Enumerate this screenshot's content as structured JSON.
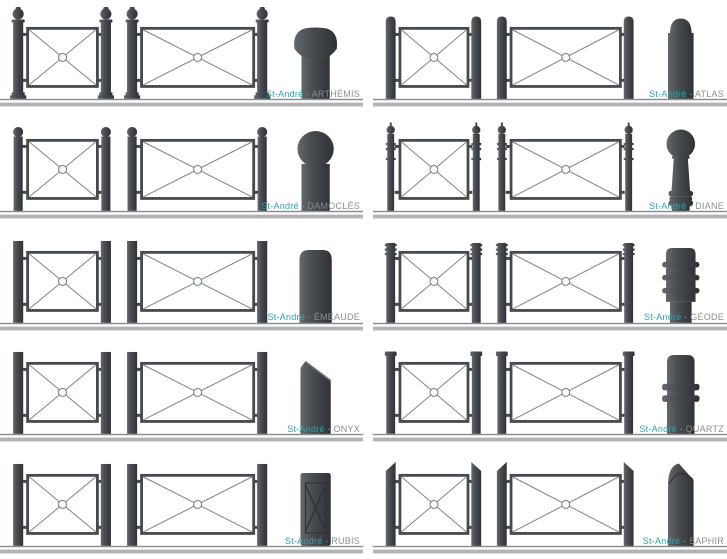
{
  "page": {
    "brand": "St-André",
    "separator": " - "
  },
  "colors": {
    "background": "#ffffff",
    "brand_text": "#2fa3aa",
    "product_text": "#8b9094",
    "metal_light": "#63686c",
    "metal_mid": "#484c50",
    "metal_dark": "#2f3337",
    "panel_frame": "#46494d",
    "panel_fill": "#ffffff",
    "panel_line": "#7f8487",
    "ground_line": "#888b8d",
    "separator_band": "#b1b3b5"
  },
  "products": [
    {
      "name": "ARTHÉMIS",
      "post_style": "ball-finial",
      "bollard_style": "mushroom-cap"
    },
    {
      "name": "ATLAS",
      "post_style": "round-top",
      "bollard_style": "dome-cylinder"
    },
    {
      "name": "DAMOCLÉS",
      "post_style": "small-ball",
      "bollard_style": "sphere-cylinder"
    },
    {
      "name": "DIANE",
      "post_style": "ringed-ball",
      "bollard_style": "pawn"
    },
    {
      "name": "ÉMEAUDE",
      "post_style": "flat-top",
      "bollard_style": "rounded-slab"
    },
    {
      "name": "GÉODE",
      "post_style": "ribbed-top",
      "bollard_style": "ribbed-cylinder"
    },
    {
      "name": "ONYX",
      "post_style": "flat-top",
      "bollard_style": "beveled-slab"
    },
    {
      "name": "QUARTZ",
      "post_style": "capped-top",
      "bollard_style": "collared-cylinder"
    },
    {
      "name": "RUBIS",
      "post_style": "flat-top",
      "bollard_style": "cross-pillar"
    },
    {
      "name": "SAPHIR",
      "post_style": "angled-top",
      "bollard_style": "angled-cylinder"
    }
  ]
}
